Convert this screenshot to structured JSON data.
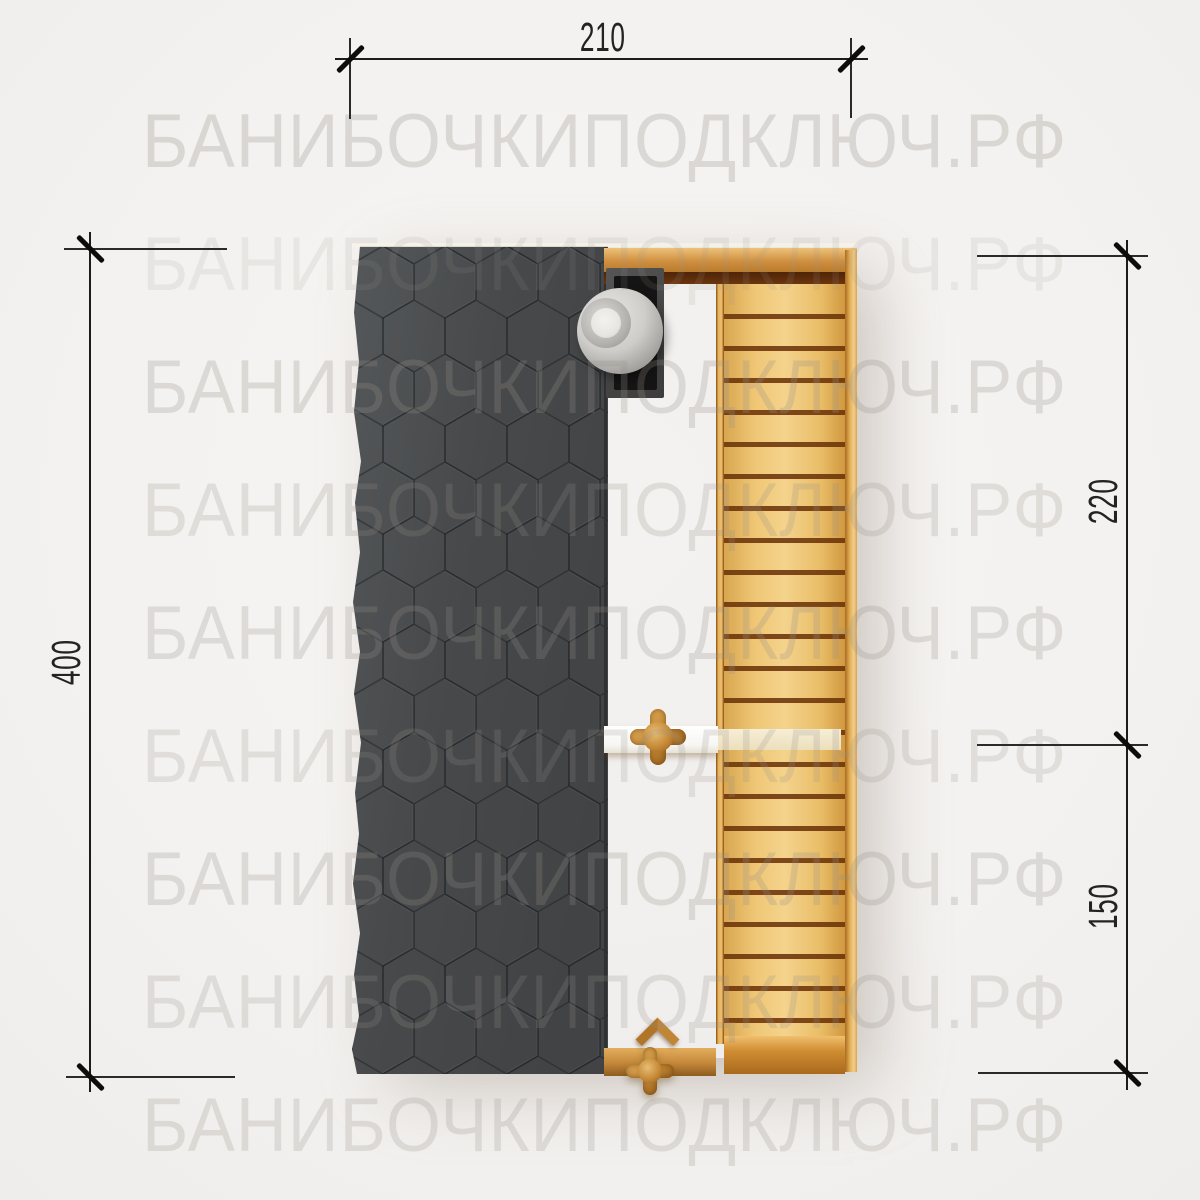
{
  "title": "Sauna barrel top view drawing",
  "watermark": {
    "text": "БАНИБОЧКИПОДКЛЮЧ.РФ",
    "row_tops": [
      104,
      227,
      350,
      473,
      596,
      719,
      842,
      965,
      1088
    ],
    "row_opacities": [
      1,
      0.5,
      0.95,
      0.8,
      0.9,
      0.75,
      0.9,
      0.8,
      0.85
    ]
  },
  "dimensions": {
    "top_width": "210",
    "left_length": "400",
    "right_upper": "220",
    "right_lower": "150"
  },
  "colors": {
    "background": "#f4f2f0",
    "watermark": "#968f87",
    "dimension_lines": "#1c1c1c",
    "roof_shingles": "#47494b",
    "roof_pattern_lines": "#191d1f",
    "door_wood": "#c98936",
    "deck_wood": "#efc675",
    "plank_groove": "#5a2a06",
    "chimney_box": "#151515",
    "chimney_cap_metal": "#cfcdca",
    "handle_bar_white": "#ffffff",
    "handle_bar_cream": "#f0e6c9",
    "knob_wood": "#c28634"
  }
}
